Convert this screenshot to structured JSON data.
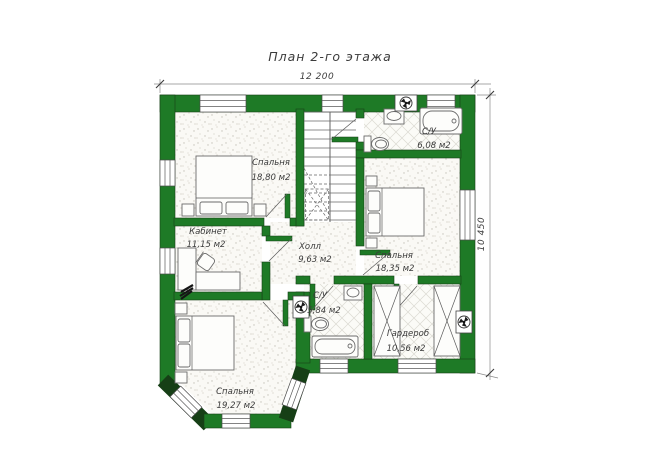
{
  "title": "План 2-го этажа",
  "dimensions": {
    "width_label": "12 200",
    "height_label": "10 450"
  },
  "rooms": [
    {
      "name": "Спальня",
      "area": "18,80 м2"
    },
    {
      "name": "С/У",
      "area": "6,08 м2"
    },
    {
      "name": "Спальня",
      "area": "18,35 м2"
    },
    {
      "name": "Кабинет",
      "area": "11,15 м2"
    },
    {
      "name": "Холл",
      "area": "9,63 м2"
    },
    {
      "name": "С/У",
      "area": "5,84 м2"
    },
    {
      "name": "Гардероб",
      "area": "10,56 м2"
    },
    {
      "name": "Спальня",
      "area": "19,27 м2"
    }
  ],
  "colors": {
    "wall": "#1e7a26",
    "line": "#5a5a5a",
    "text": "#3c3c3c"
  }
}
